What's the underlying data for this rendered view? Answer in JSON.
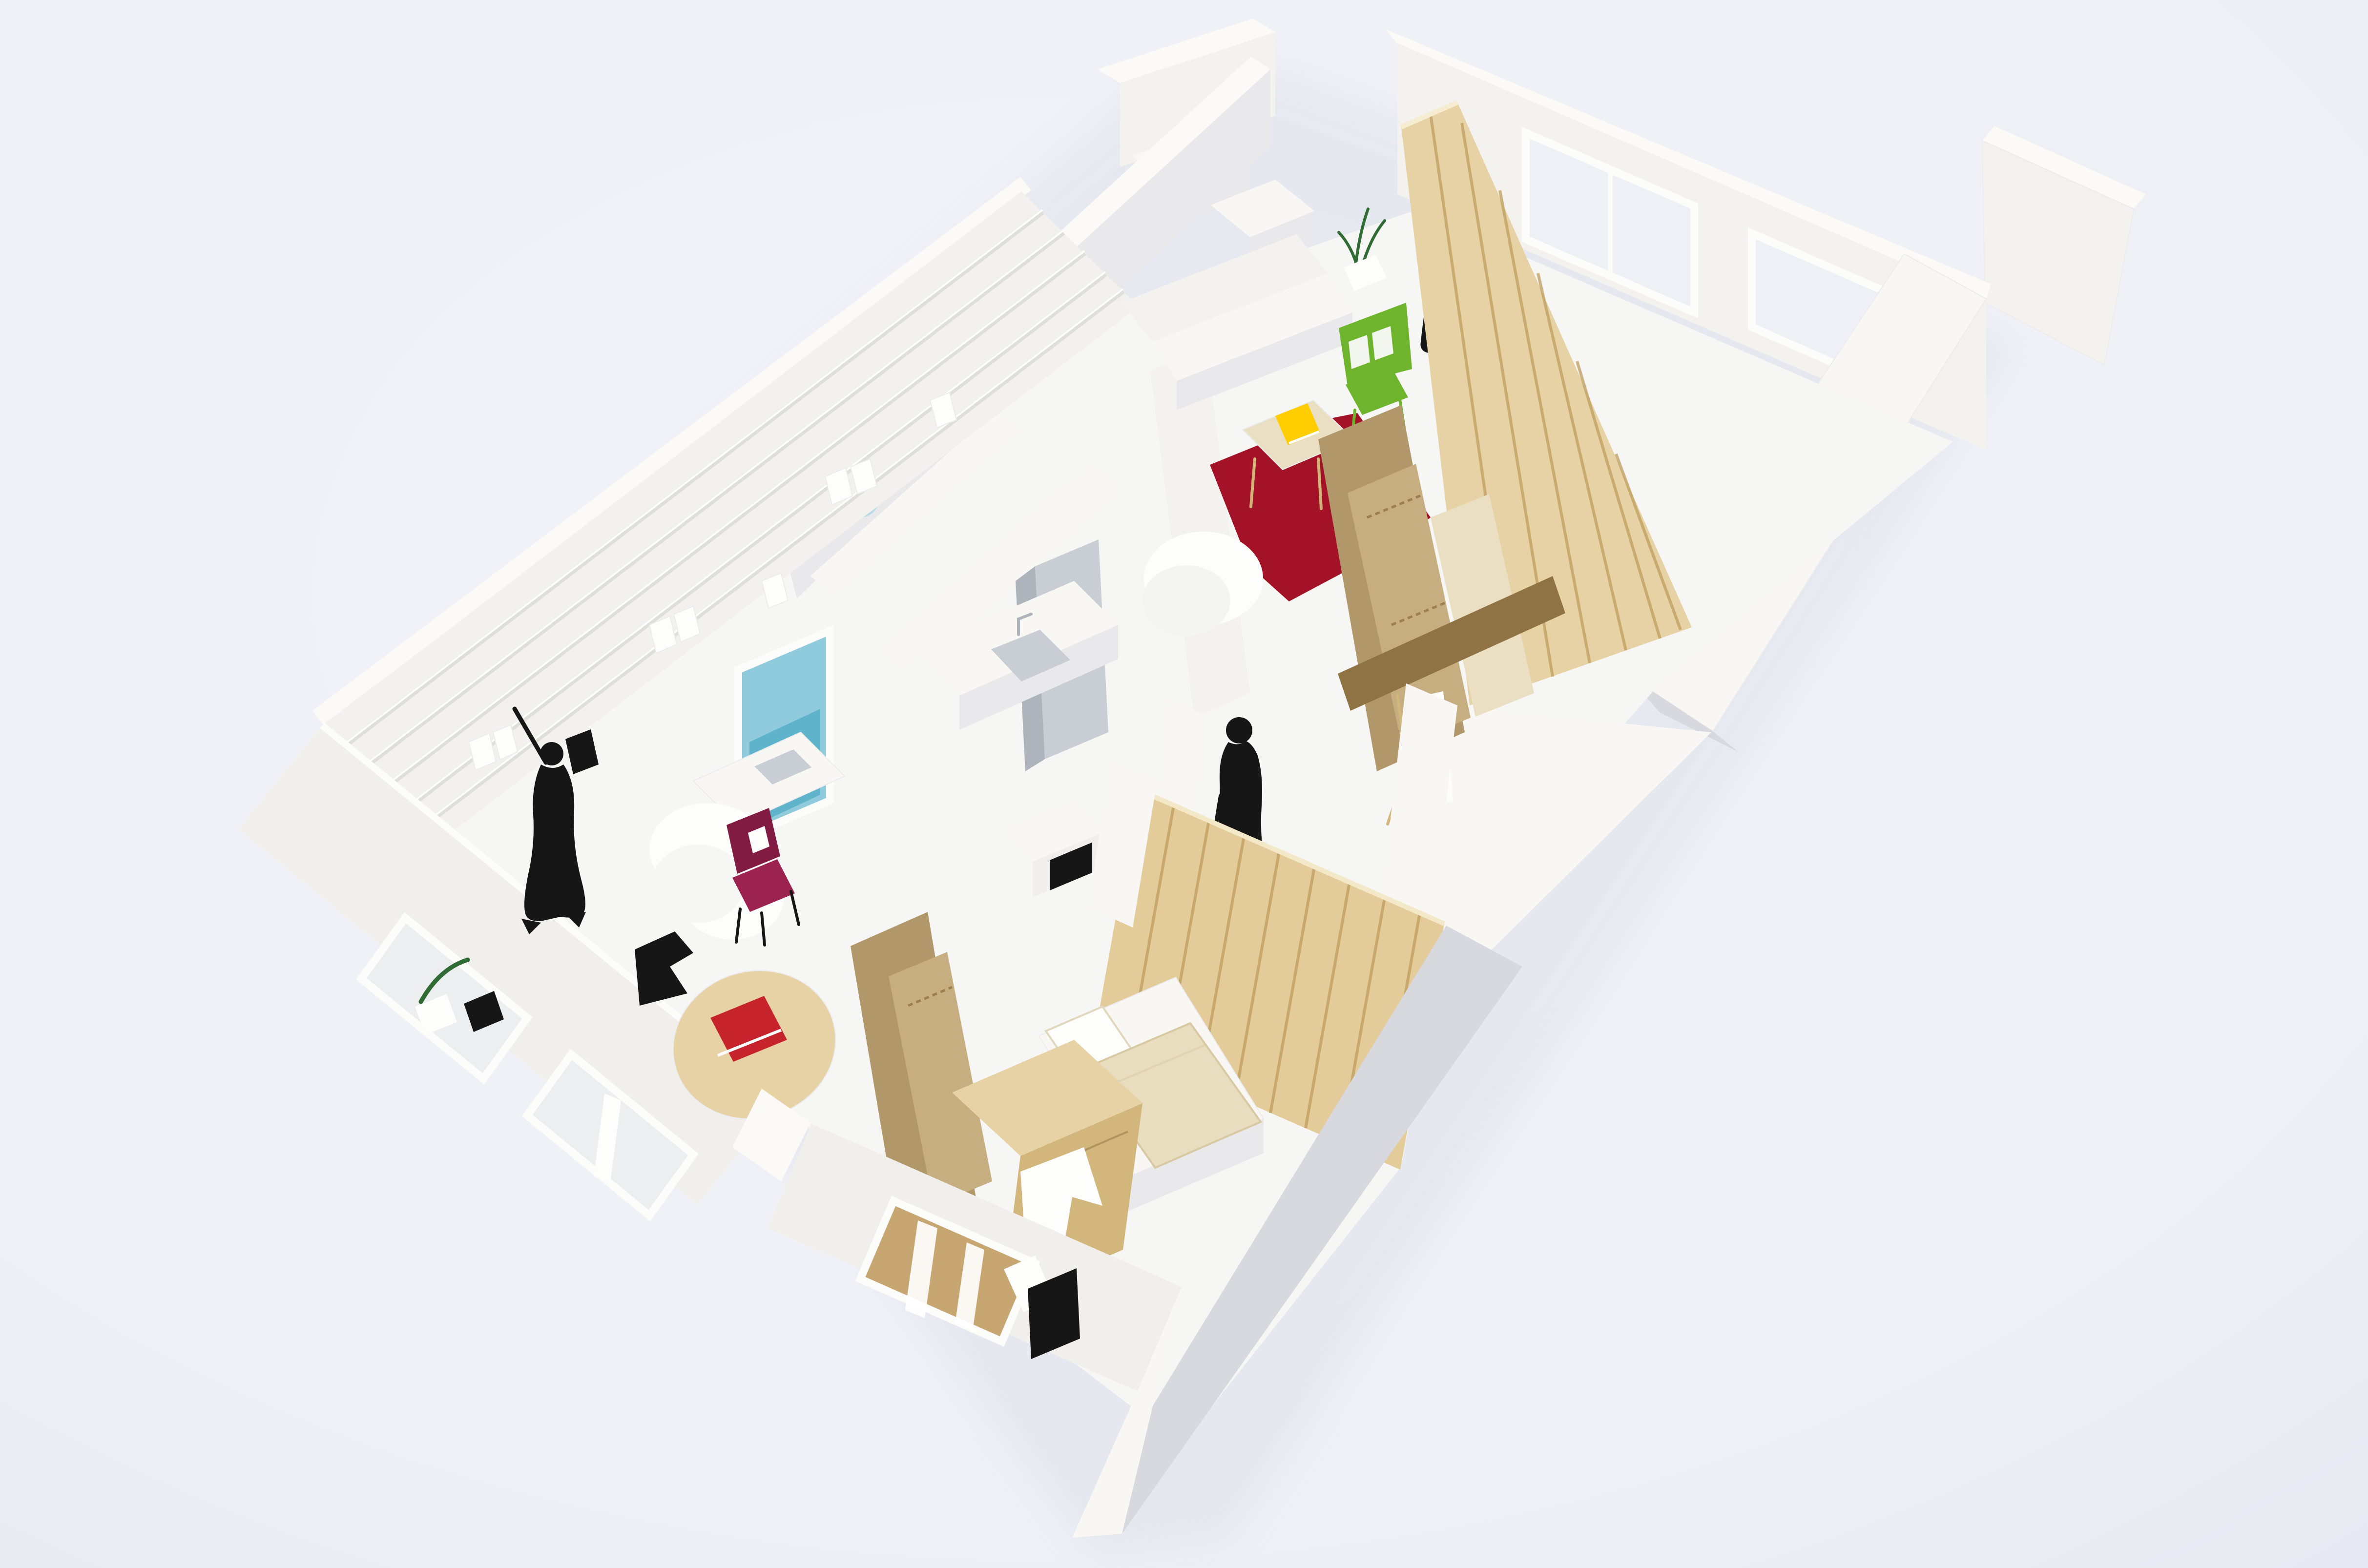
{
  "scene": {
    "type": "photograph",
    "subject": "Architectural scale model (maquette) of a small apartment seen from above at an oblique angle",
    "materials": "white foam-board walls, balsa and pine wood partitions, corrugated cardboard panels, paper furniture, black paper figure silhouettes",
    "backdrop": "seamless pale studio background"
  },
  "colors": {
    "background": "#eef0f6",
    "vignette": "#e4e7f0",
    "shadow": "#9aa0b4",
    "floor": "#f6f6f4",
    "wallTop": "#fbfaf7",
    "wallLit": "#f4f2ee",
    "wallLit2": "#f1efeb",
    "wallFace": "#f3f1ed",
    "wallBright": "#f8f7f4",
    "wallCool": "#e9e9ec",
    "wallShade": "#d7d9de",
    "interiorShade": "#eceef0",
    "balsa": "#e6d2a4",
    "balsaDark": "#d2b67c",
    "balsaPale": "#eadfc2",
    "pine": "#e3cb9a",
    "pineDark": "#bf9c5d",
    "cardboard": "#b1976a",
    "cardFlute": "#c7ae80",
    "cardDark": "#8f7344",
    "crimson": "#a31226",
    "green": "#6eb42d",
    "greenDark": "#2f6b33",
    "yellow": "#ffcd00",
    "redBook": "#c6232c",
    "magenta": "#9c2350",
    "magentaDark": "#821b41",
    "paleBlue": "#b5dde8",
    "blueGlass": "#8fcbdc",
    "blueDeep": "#5fb4cb",
    "black": "#161616",
    "linen": "#e9ddc0",
    "linenEdge": "#d9c9a2",
    "woodFloor": "#c8a672",
    "white": "#fdfdfc",
    "grey": "#c9ced4",
    "greyDark": "#aeb4bb"
  },
  "objects": [
    {
      "id": "living-room",
      "label": "living room with crimson rug, balsa coffee table, yellow book, green chair, white bench sofa, plant"
    },
    {
      "id": "bedroom-right",
      "label": "right room behind balsa slat partition with black paper artwork and easel"
    },
    {
      "id": "library",
      "label": "left room with white shelving wall, small books, fold-out desk, sheepskin rug"
    },
    {
      "id": "dining",
      "label": "round balsa table with red book and magenta chair"
    },
    {
      "id": "kitchen",
      "label": "white counter with grey sink and tall grey cabinet"
    },
    {
      "id": "bathroom",
      "label": "shower stall with pale blue shower head and blue glazed bath window"
    },
    {
      "id": "bedroom-bottom",
      "label": "bedroom with pine slat wall, single bed with linen blanket, black TV, balsa wardrobe, cardboard partitions"
    },
    {
      "id": "figures",
      "label": "three black paper silhouettes: standing person, elderly person with cane, person reaching to shelf"
    }
  ]
}
